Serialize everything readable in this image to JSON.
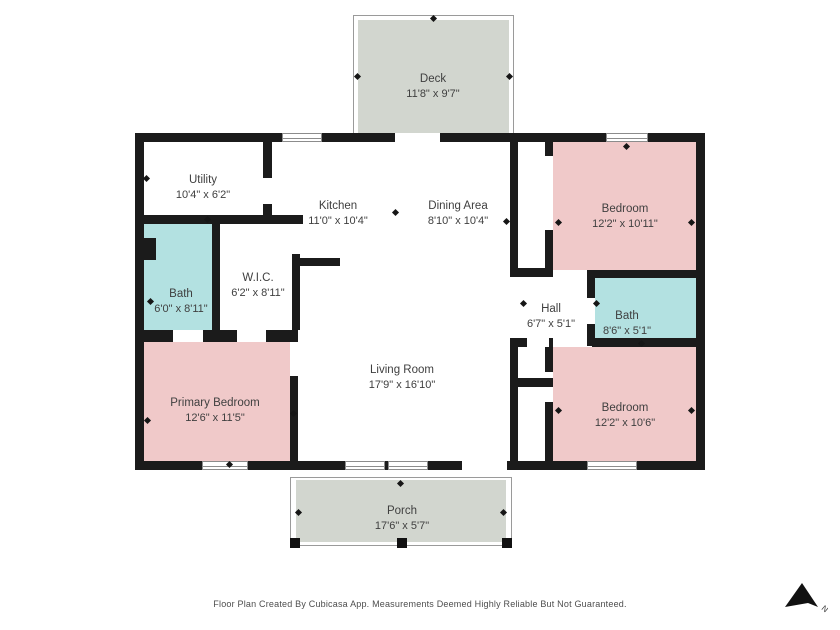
{
  "footer": {
    "text": "Floor Plan Created By Cubicasa App. Measurements Deemed Highly Reliable But Not Guaranteed."
  },
  "compass": {
    "label": "N"
  },
  "colors": {
    "bedroom_fill": "#f0c9c9",
    "bath_fill": "#b3e1e1",
    "outdoor_fill": "#d2d6cf",
    "wall": "#1b1b1b",
    "label_text": "#3f3f3f",
    "footer_text": "#4d4d4d"
  },
  "rooms": [
    {
      "id": "deck",
      "name": "Deck",
      "dims": "11'8\" x 9'7\""
    },
    {
      "id": "utility",
      "name": "Utility",
      "dims": "10'4\" x 6'2\""
    },
    {
      "id": "kitchen",
      "name": "Kitchen",
      "dims": "11'0\" x 10'4\""
    },
    {
      "id": "dining-area",
      "name": "Dining Area",
      "dims": "8'10\" x 10'4\""
    },
    {
      "id": "bedroom-top",
      "name": "Bedroom",
      "dims": "12'2\" x 10'11\""
    },
    {
      "id": "bath-left",
      "name": "Bath",
      "dims": "6'0\" x 8'11\""
    },
    {
      "id": "wic",
      "name": "W.I.C.",
      "dims": "6'2\" x 8'11\""
    },
    {
      "id": "hall",
      "name": "Hall",
      "dims": "6'7\" x 5'1\""
    },
    {
      "id": "bath-right",
      "name": "Bath",
      "dims": "8'6\" x 5'1\""
    },
    {
      "id": "living-room",
      "name": "Living Room",
      "dims": "17'9\" x 16'10\""
    },
    {
      "id": "primary-bedroom",
      "name": "Primary Bedroom",
      "dims": "12'6\" x 11'5\""
    },
    {
      "id": "bedroom-bottom",
      "name": "Bedroom",
      "dims": "12'2\" x 10'6\""
    },
    {
      "id": "porch",
      "name": "Porch",
      "dims": "17'6\" x 5'7\""
    }
  ]
}
